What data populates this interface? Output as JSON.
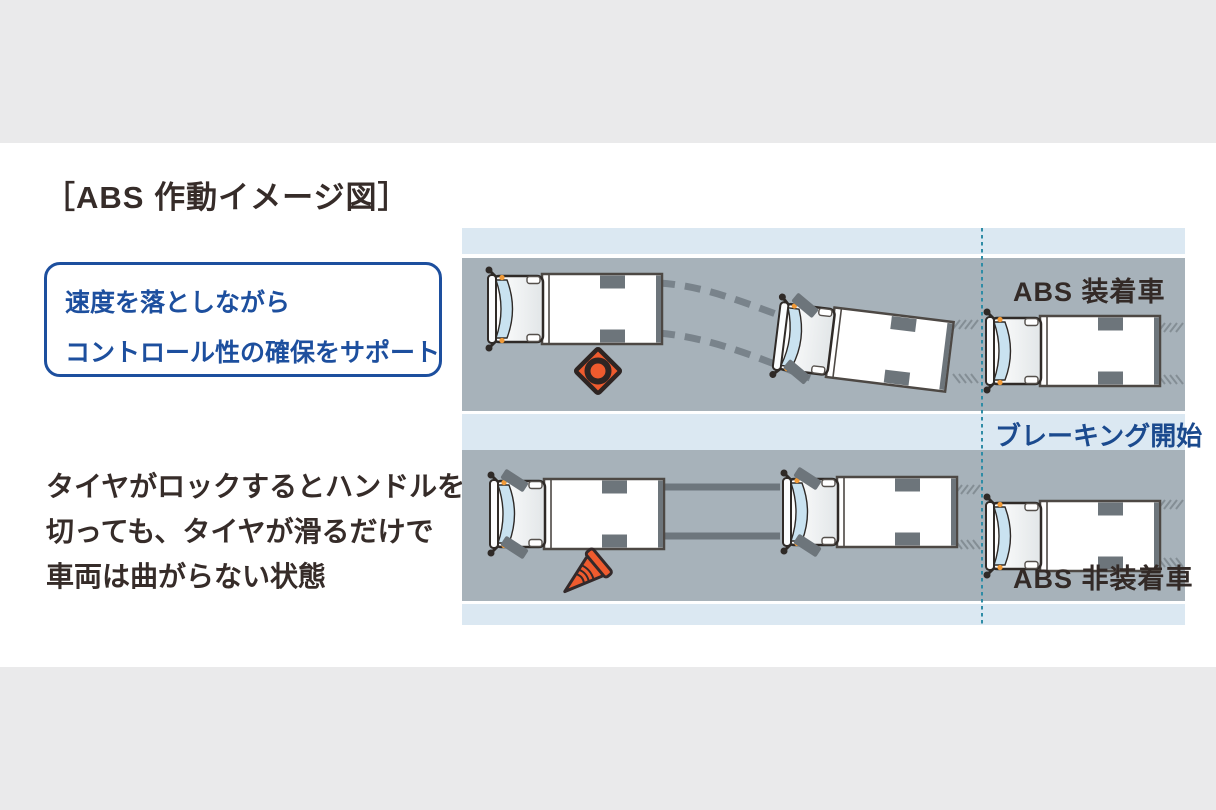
{
  "title": "［ABS 作動イメージ図］",
  "callout": {
    "line1": "速度を落としながら",
    "line2": "コントロール性の確保をサポート"
  },
  "description": {
    "line1": "タイヤがロックするとハンドルを",
    "line2": "切っても、タイヤが滑るだけで",
    "line3": "車両は曲がらない状態"
  },
  "diagram": {
    "abs_equipped_label": "ABS 装着車",
    "braking_start_label": "ブレーキング開始",
    "abs_not_equipped_label": "ABS 非装着車",
    "icons": {
      "top_road_obstacle": "traffic-cone-top-view-icon",
      "bottom_road_obstacle": "traffic-cone-knocked-over-icon"
    },
    "colors": {
      "road_gray": "#a7b2ba",
      "light_blue_band": "#dbe8f2",
      "accent_blue": "#1d4f9e",
      "braking_text_blue": "#1b4a8e",
      "guide_line_teal": "#2f8ca6",
      "cone_orange": "#ef5b2e",
      "dark_text": "#362c29",
      "page_band_gray": "#eaeaeb"
    }
  }
}
